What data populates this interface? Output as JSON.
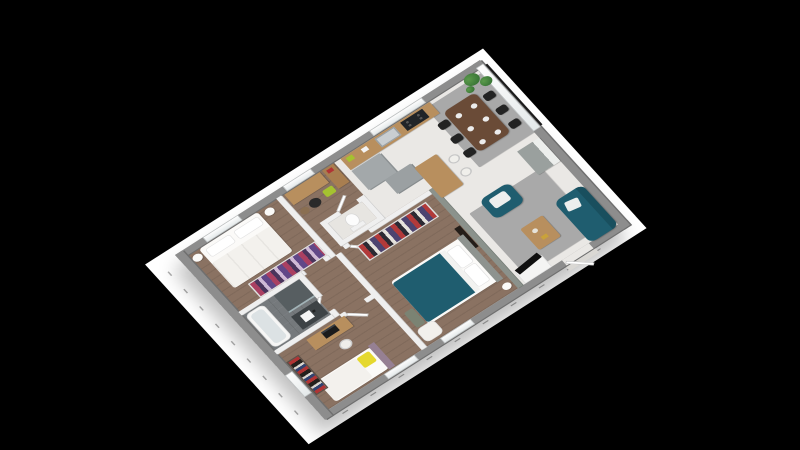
{
  "scene": {
    "description": "3D isometric rendering of a single-storey 3-bedroom house floor plan on a white sheet over a black background",
    "background_color": "#000000",
    "paper_color": "#ffffff",
    "visible_text": "none (dimension marks along two outer walls are too small to read)"
  },
  "colors": {
    "bg": "#000000",
    "paper": "#ffffff",
    "ext_wall": "#8d8d8d",
    "ext_wall_edge": "#6f6f6f",
    "int_wall": "#efefef",
    "int_wall_edge": "#cdcdcd",
    "divider_wall": "#8b928c",
    "light_floor": "#eae8e5",
    "wood_floor": "#8a7262",
    "bath_floor": "#75797c",
    "rug": "#a9a9a9",
    "teal": "#1f5d6f",
    "teal_dark": "#194f5e",
    "wood": "#b88f5e",
    "dining_table": "#6a4b37",
    "black_chair": "#232323",
    "gray_unit": "#a3a8aa",
    "sideboard": "#9aa09e",
    "lime": "#a5c230",
    "yellow": "#e5d82f",
    "mauve": "#968093",
    "plant": "#3f7c3a",
    "tick": "#adadad",
    "white_furn": "#fbfaf8"
  },
  "rooms": {
    "bedroom1": {
      "name": "Bedroom 1 (white double bed)",
      "floor": "wood"
    },
    "hall": {
      "name": "Entry hall with console",
      "floor": "wood"
    },
    "wc": {
      "name": "WC",
      "floor": "light tile"
    },
    "kitchen": {
      "name": "Open kitchen",
      "floor": "light tile"
    },
    "dining": {
      "name": "Dining area",
      "floor": "light tile"
    },
    "living": {
      "name": "Living room",
      "floor": "light tile"
    },
    "bathroom": {
      "name": "Bathroom",
      "floor": "dark tile"
    },
    "corridor": {
      "name": "Corridor",
      "floor": "wood"
    },
    "bedroom2": {
      "name": "Kids bedroom (bed with yellow pillow)",
      "floor": "wood"
    },
    "bedroom3": {
      "name": "Master bedroom (teal double bed)",
      "floor": "wood"
    }
  },
  "labels": {
    "paper": "white plan sheet",
    "dimension_marks": "illegible dimension tick marks",
    "b1_bed": "double bed with white bedding",
    "b1_nightstand": "round nightstand",
    "b1_wardrobe": "open wardrobe with hanging clothes",
    "hall_console": "wooden console desk",
    "hall_dresser": "tall wooden dresser",
    "hall_stool": "black stool",
    "hall_green_chair": "lime green seat",
    "hall_basket": "round basket",
    "wc_toilet": "toilet",
    "kitchen_counter": "kitchen counter",
    "kitchen_sink": "sink",
    "kitchen_stove": "cooktop",
    "kitchen_unit": "gray kitchen unit",
    "kitchen_island": "wooden bar island",
    "bar_stool": "white bar stool",
    "dining_table": "dark wood dining table with place settings",
    "dining_chair": "black dining chair",
    "plant": "potted green plant",
    "sideboard": "gray sideboard",
    "sofa": "teal two-seat sofa with white cushion",
    "armchair": "teal armchair with white cushion",
    "coffee_table": "wooden coffee table with decor",
    "tv_unit": "TV on white media unit",
    "entry_door": "open entry door",
    "interior_door": "open interior door",
    "window": "window",
    "balcony_glazing": "full-height glazed bay with dark railing",
    "bath_tub": "bathtub",
    "shower": "walk-in shower",
    "vanity": "dark vanity with sink",
    "master_bed": "double bed with teal duvet and white pillows",
    "master_wardrobe": "open wardrobe with hanging clothes",
    "master_tv": "wall TV panel",
    "master_bench": "bedroom bench",
    "master_armchair": "white armchair",
    "kid_bed": "single bed with yellow pillow and mauve headboard",
    "kid_desk": "desk with dark laptop",
    "kid_stool": "white stool",
    "bookshelf": "bookshelf with colorful books",
    "rug": "gray rug"
  }
}
